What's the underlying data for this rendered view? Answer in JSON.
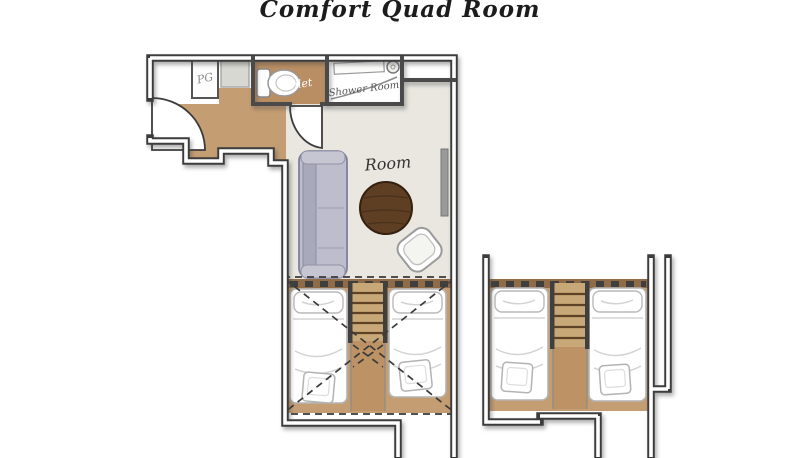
{
  "title": "Comfort Quad Room",
  "labels": {
    "closet": "PG",
    "toilet": "Toilet",
    "shower_room": "Shower Room",
    "room": "Room"
  },
  "palette": {
    "wall": "#3c3c3c",
    "wood_floor": "#c59d72",
    "toilet_floor": "#b98e62",
    "room_floor": "#e9e7e0",
    "headboard_band": "#8f6b48",
    "stairs": "#c9a877",
    "stair_rail": "#3f3f3f",
    "sofa": "#bdbdcb",
    "coffee_table": "#5e3f24",
    "radiator": "#9a9a9a",
    "bed": "#ffffff",
    "background": "#ffffff"
  }
}
